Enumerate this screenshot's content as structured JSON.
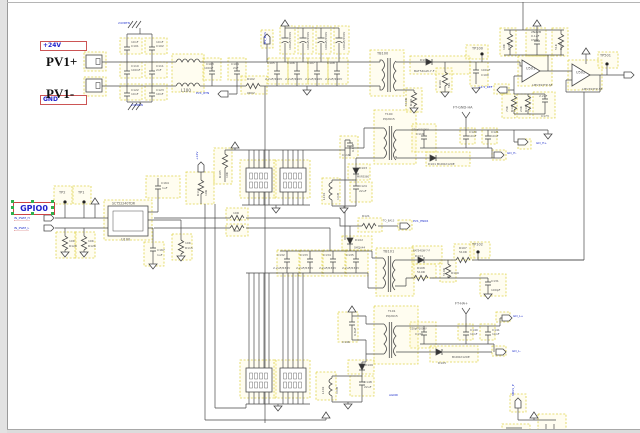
{
  "window": {
    "title": "schematic-canvas"
  },
  "colors": {
    "wire": "#4a4a4a",
    "highlight": "#e0d44c",
    "net_box_border": "#cc5555",
    "net_text": "#2222cc",
    "selection_handle": "#2fb14d",
    "tiny_text": "#555555"
  },
  "net_labels": {
    "v24": "+24V",
    "gnd": "GND",
    "gpio0": "GPIO0"
  },
  "connectors": {
    "pv1p": "PV1+",
    "pv1m": "PV1-"
  },
  "texts": [
    {
      "t": "24VRTN",
      "x": 118,
      "y": 22,
      "c": "b"
    },
    {
      "t": "10nF",
      "x": 131,
      "y": 41
    },
    {
      "t": "C101",
      "x": 131,
      "y": 45
    },
    {
      "t": "10nF",
      "x": 156,
      "y": 41
    },
    {
      "t": "C102",
      "x": 156,
      "y": 45
    },
    {
      "t": "C110",
      "x": 131,
      "y": 65
    },
    {
      "t": "100nF",
      "x": 131,
      "y": 69
    },
    {
      "t": "C111",
      "x": 156,
      "y": 65
    },
    {
      "t": "2nF",
      "x": 156,
      "y": 69
    },
    {
      "t": "C122",
      "x": 131,
      "y": 89
    },
    {
      "t": "10nF",
      "x": 131,
      "y": 93
    },
    {
      "t": "C123",
      "x": 156,
      "y": 89
    },
    {
      "t": "10nF",
      "x": 156,
      "y": 93
    },
    {
      "t": "24VRTN",
      "x": 131,
      "y": 104,
      "c": "b"
    },
    {
      "t": "L100",
      "x": 181,
      "y": 89,
      "s": 4
    },
    {
      "t": "C103",
      "x": 206,
      "y": 63
    },
    {
      "t": "100nF",
      "x": 204,
      "y": 67
    },
    {
      "t": "C104",
      "x": 231,
      "y": 63
    },
    {
      "t": "2nF",
      "x": 233,
      "y": 67
    },
    {
      "t": "R102",
      "x": 247,
      "y": 78
    },
    {
      "t": "0R02",
      "x": 247,
      "y": 92
    },
    {
      "t": "PV1_RTN",
      "x": 196,
      "y": 92,
      "c": "b"
    },
    {
      "t": "HV_BUS",
      "x": 264,
      "y": 44,
      "c": "b",
      "r": 1
    },
    {
      "t": "100uF/450V",
      "x": 289,
      "y": 50,
      "r": 1
    },
    {
      "t": "100uF/450V",
      "x": 307,
      "y": 50,
      "r": 1
    },
    {
      "t": "100uF/450V",
      "x": 325,
      "y": 50,
      "r": 1
    },
    {
      "t": "100uF/450V",
      "x": 343,
      "y": 50,
      "r": 1
    },
    {
      "t": "C105",
      "x": 267,
      "y": 62
    },
    {
      "t": "2.2uF/450V",
      "x": 265,
      "y": 78
    },
    {
      "t": "C106",
      "x": 287,
      "y": 62
    },
    {
      "t": "2.2uF/450V",
      "x": 285,
      "y": 78
    },
    {
      "t": "C107",
      "x": 307,
      "y": 62
    },
    {
      "t": "2.2uF/450V",
      "x": 305,
      "y": 78
    },
    {
      "t": "C108",
      "x": 327,
      "y": 62
    },
    {
      "t": "2.2uF/450V",
      "x": 325,
      "y": 78
    },
    {
      "t": "TB100",
      "x": 377,
      "y": 52,
      "s": 3.5
    },
    {
      "t": "T100",
      "x": 385,
      "y": 113
    },
    {
      "t": "PQ2615",
      "x": 383,
      "y": 117.5
    },
    {
      "t": "D100",
      "x": 420,
      "y": 59
    },
    {
      "t": "BAT54GW-7-F",
      "x": 414,
      "y": 70
    },
    {
      "t": "510R",
      "x": 405,
      "y": 106,
      "r": 1
    },
    {
      "t": "R101",
      "x": 410,
      "y": 106,
      "r": 1
    },
    {
      "t": "R104",
      "x": 439,
      "y": 88,
      "r": 1
    },
    {
      "t": "5K1",
      "x": 448,
      "y": 88,
      "r": 1
    },
    {
      "t": "100uF",
      "x": 481,
      "y": 69
    },
    {
      "t": "C100",
      "x": 481,
      "y": 73.5
    },
    {
      "t": "TP100",
      "x": 472,
      "y": 47,
      "s": 3.5
    },
    {
      "t": "FT-GND-HA",
      "x": 453,
      "y": 106,
      "s": 3.5
    },
    {
      "t": "220pF/1000V",
      "x": 412,
      "y": 129,
      "s": 2.5
    },
    {
      "t": "C119",
      "x": 416,
      "y": 133
    },
    {
      "t": "C120",
      "x": 469,
      "y": 131
    },
    {
      "t": "10nF",
      "x": 469,
      "y": 135
    },
    {
      "t": "C121",
      "x": 491,
      "y": 131
    },
    {
      "t": "10nF",
      "x": 491,
      "y": 135
    },
    {
      "t": "D101  B1D62120E",
      "x": 428,
      "y": 163,
      "s": 3
    },
    {
      "t": "GD_H+",
      "x": 536,
      "y": 142,
      "c": "b"
    },
    {
      "t": "GD_H-",
      "x": 507,
      "y": 152,
      "c": "b"
    },
    {
      "t": "10K",
      "x": 503,
      "y": 50,
      "r": 1
    },
    {
      "t": "R167",
      "x": 507.5,
      "y": 50,
      "r": 1
    },
    {
      "t": "2N22B",
      "x": 531,
      "y": 31
    },
    {
      "t": "0.1uF",
      "x": 531,
      "y": 35
    },
    {
      "t": "C502",
      "x": 531,
      "y": 39
    },
    {
      "t": "51K",
      "x": 555,
      "y": 50,
      "r": 1
    },
    {
      "t": "R169",
      "x": 559.5,
      "y": 50,
      "r": 1
    },
    {
      "t": "U501",
      "x": 526,
      "y": 67,
      "s": 3.5
    },
    {
      "t": "LMV393TP-SE",
      "x": 532,
      "y": 84
    },
    {
      "t": "U502",
      "x": 576,
      "y": 71,
      "s": 3.5
    },
    {
      "t": "LMV393TP-SE",
      "x": 582,
      "y": 88
    },
    {
      "t": "TP501",
      "x": 600,
      "y": 54,
      "s": 3.5
    },
    {
      "t": "+2.5_REF",
      "x": 478,
      "y": 86,
      "c": "b"
    },
    {
      "t": "74K",
      "x": 506,
      "y": 112,
      "r": 1
    },
    {
      "t": "R174",
      "x": 510.5,
      "y": 112,
      "r": 1
    },
    {
      "t": "24K",
      "x": 520,
      "y": 112,
      "r": 1
    },
    {
      "t": "R173",
      "x": 524.5,
      "y": 112,
      "r": 1
    },
    {
      "t": "2.2uF",
      "x": 539,
      "y": 95
    },
    {
      "t": "C173",
      "x": 541,
      "y": 115
    },
    {
      "t": "6.8uF",
      "x": 352,
      "y": 152,
      "r": 1
    },
    {
      "t": "C116",
      "x": 342,
      "y": 154
    },
    {
      "t": "D103",
      "x": 359,
      "y": 167
    },
    {
      "t": "MURS360",
      "x": 357,
      "y": 176,
      "s": 2.5
    },
    {
      "t": "L101",
      "x": 323,
      "y": 200,
      "r": 1
    },
    {
      "t": "1mH",
      "x": 337,
      "y": 200,
      "r": 1
    },
    {
      "t": "C124",
      "x": 359,
      "y": 185
    },
    {
      "t": "22uF",
      "x": 359,
      "y": 189.5
    },
    {
      "t": "R121",
      "x": 362,
      "y": 215
    },
    {
      "t": "TO_BA13",
      "x": 383,
      "y": 220,
      "s": 2.5
    },
    {
      "t": "PV1_EN06",
      "x": 413,
      "y": 220,
      "c": "b"
    },
    {
      "t": "D102",
      "x": 355,
      "y": 239
    },
    {
      "t": "SMCJA44",
      "x": 354,
      "y": 247,
      "s": 2.5
    },
    {
      "t": "C132",
      "x": 277,
      "y": 254
    },
    {
      "t": "2.2uF/630V",
      "x": 273,
      "y": 267
    },
    {
      "t": "C133",
      "x": 300,
      "y": 254
    },
    {
      "t": "2.2uF/630V",
      "x": 296,
      "y": 267
    },
    {
      "t": "C134",
      "x": 323,
      "y": 254
    },
    {
      "t": "2.2uF/630V",
      "x": 319,
      "y": 267
    },
    {
      "t": "C135",
      "x": 346,
      "y": 254
    },
    {
      "t": "2.2uF/630V",
      "x": 342,
      "y": 267
    },
    {
      "t": "TB101",
      "x": 383,
      "y": 250,
      "s": 3.5
    },
    {
      "t": "BAT54GW-7-F",
      "x": 413,
      "y": 250,
      "s": 2.5
    },
    {
      "t": "D104",
      "x": 415,
      "y": 255
    },
    {
      "t": "R107",
      "x": 459,
      "y": 247
    },
    {
      "t": "510R",
      "x": 459,
      "y": 251
    },
    {
      "t": "TP102",
      "x": 472,
      "y": 243,
      "s": 3.5
    },
    {
      "t": "R108",
      "x": 417,
      "y": 267
    },
    {
      "t": "510R",
      "x": 417,
      "y": 271
    },
    {
      "t": "510R",
      "x": 443,
      "y": 276,
      "r": 1
    },
    {
      "t": "R109",
      "x": 451,
      "y": 272
    },
    {
      "t": "C131",
      "x": 491,
      "y": 280
    },
    {
      "t": "100pF",
      "x": 491,
      "y": 289
    },
    {
      "t": "FT-HA+",
      "x": 455,
      "y": 302,
      "s": 3.5
    },
    {
      "t": "220pF/1000V",
      "x": 410,
      "y": 328,
      "s": 2.5
    },
    {
      "t": "C139",
      "x": 415,
      "y": 332.5
    },
    {
      "t": "C140",
      "x": 470,
      "y": 329
    },
    {
      "t": "10nF",
      "x": 470,
      "y": 333
    },
    {
      "t": "C141",
      "x": 492,
      "y": 329
    },
    {
      "t": "10nF",
      "x": 492,
      "y": 333
    },
    {
      "t": "GD_L+",
      "x": 513,
      "y": 315,
      "c": "b"
    },
    {
      "t": "GD_L-",
      "x": 512,
      "y": 350,
      "c": "b"
    },
    {
      "t": "B1D62120E",
      "x": 452,
      "y": 356
    },
    {
      "t": "D105",
      "x": 438,
      "y": 362
    },
    {
      "t": "T101",
      "x": 388,
      "y": 310
    },
    {
      "t": "PQ2615",
      "x": 386,
      "y": 314.5
    },
    {
      "t": "6.8uF",
      "x": 354,
      "y": 336,
      "r": 1
    },
    {
      "t": "C146",
      "x": 342,
      "y": 341
    },
    {
      "t": "D106",
      "x": 365,
      "y": 364
    },
    {
      "t": "L102",
      "x": 322,
      "y": 394,
      "r": 1
    },
    {
      "t": "1mH",
      "x": 336,
      "y": 394,
      "r": 1
    },
    {
      "t": "C148",
      "x": 364,
      "y": 381
    },
    {
      "t": "22uF",
      "x": 364,
      "y": 385.5
    },
    {
      "t": "AGND",
      "x": 389,
      "y": 394,
      "c": "b"
    },
    {
      "t": "VBUS_P",
      "x": 512,
      "y": 396,
      "c": "b",
      "r": 1
    },
    {
      "t": "IN_PWM_H",
      "x": 14,
      "y": 217,
      "c": "b",
      "u": 1
    },
    {
      "t": "IN_PWM_L",
      "x": 14,
      "y": 227,
      "c": "b",
      "u": 1
    },
    {
      "t": "TP2",
      "x": 59,
      "y": 191,
      "s": 3.5
    },
    {
      "t": "TP1",
      "x": 78,
      "y": 191,
      "s": 3.5
    },
    {
      "t": "SCT52240TDR",
      "x": 112,
      "y": 202,
      "s": 3.2
    },
    {
      "t": "U100",
      "x": 121,
      "y": 238,
      "s": 3.5
    },
    {
      "t": "10K",
      "x": 69,
      "y": 240
    },
    {
      "t": "R128",
      "x": 69,
      "y": 244.5
    },
    {
      "t": "10K",
      "x": 88,
      "y": 240
    },
    {
      "t": "R126",
      "x": 88,
      "y": 244.5
    },
    {
      "t": "C167",
      "x": 157,
      "y": 249
    },
    {
      "t": "1uF",
      "x": 157,
      "y": 253.5
    },
    {
      "t": "10K",
      "x": 185,
      "y": 242
    },
    {
      "t": "R115",
      "x": 185,
      "y": 246.5
    },
    {
      "t": "C164",
      "x": 161,
      "y": 182
    },
    {
      "t": "1uF",
      "x": 162,
      "y": 186.5
    },
    {
      "t": "R116",
      "x": 197,
      "y": 196,
      "r": 1
    },
    {
      "t": "10R",
      "x": 205,
      "y": 196,
      "r": 1
    },
    {
      "t": "+12V",
      "x": 196,
      "y": 160,
      "c": "b",
      "r": 1
    },
    {
      "t": "R105",
      "x": 219,
      "y": 178,
      "r": 1
    },
    {
      "t": "10K",
      "x": 226,
      "y": 178,
      "r": 1
    },
    {
      "t": "10R",
      "x": 233,
      "y": 212
    },
    {
      "t": "30R",
      "x": 233,
      "y": 230
    }
  ]
}
